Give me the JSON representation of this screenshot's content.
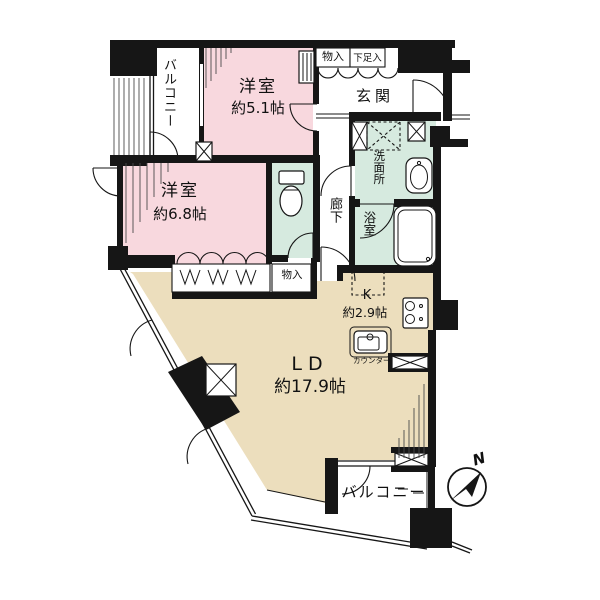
{
  "plan": {
    "balcony_top_label": "バルコニー",
    "bedroom1": {
      "name": "洋室",
      "size": "約5.1帖"
    },
    "closet_top_label": "物入",
    "shoe_box_label": "下足入",
    "entrance_label": "玄関",
    "washroom_label": "洗面所",
    "bathroom_label": "浴室",
    "hallway_label": "廊下",
    "bedroom2": {
      "name": "洋室",
      "size": "約6.8帖"
    },
    "closet2_label": "物入",
    "kitchen": {
      "name": "K",
      "size": "約2.9帖"
    },
    "counter_label": "カウンター",
    "living_dining": {
      "name": "LD",
      "size": "約17.9帖"
    },
    "balcony_bottom_label": "バルコニー",
    "compass_label": "N"
  },
  "colors": {
    "bedroom_pink": "#f8d8de",
    "wet_area_mint": "#d6eadf",
    "living_beige": "#ecdebd",
    "wall_black": "#161616"
  }
}
